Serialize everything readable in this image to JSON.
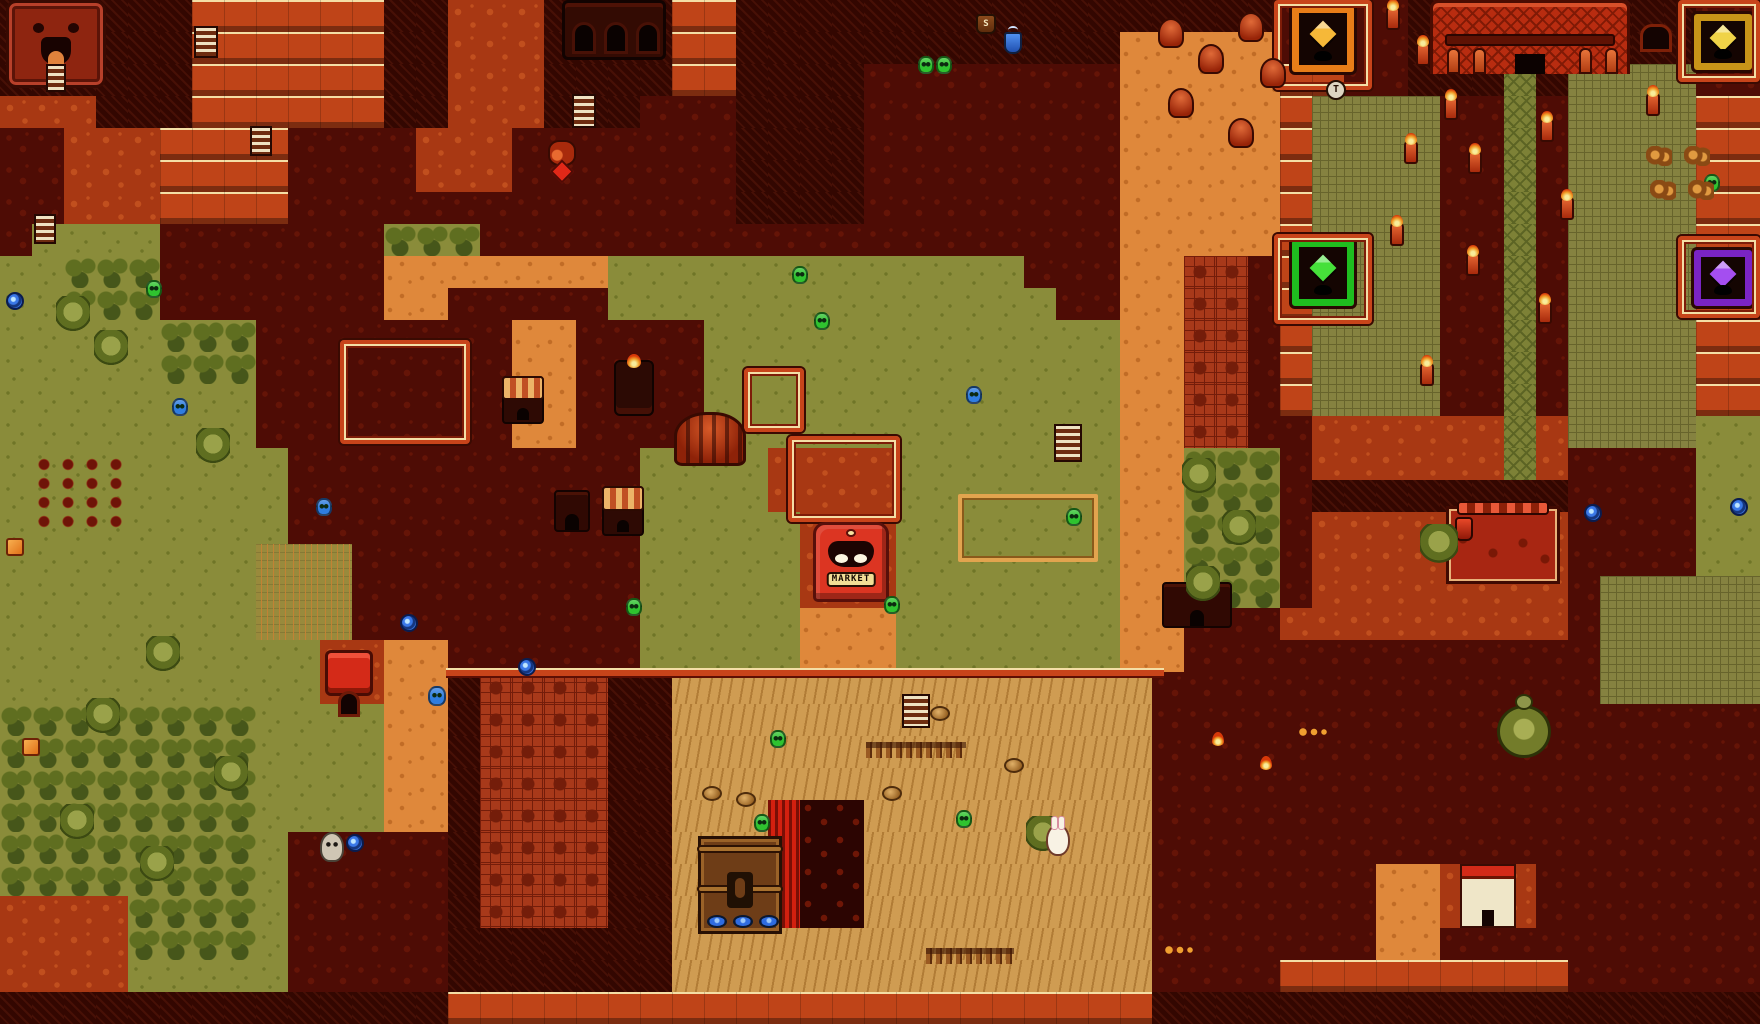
{
  "game": {
    "description": "8-bit volcanic overworld map (Subrosia-style), top-down tile view",
    "visible_text": [
      "MARKET",
      "T",
      "S"
    ]
  },
  "palette": {
    "d": "#4e0c05",
    "d2": "#651407",
    "D": "#330701",
    "D2": "#471006",
    "r": "#a83813",
    "r2": "#c14f1e",
    "R": "#bf4418",
    "R2": "#f4dfa6",
    "o": "#df883b",
    "o2": "#c16c26",
    "g": "#8a8c3a",
    "g2": "#6f7527",
    "t1": "#5f6e20",
    "t2": "#46561a",
    "w": "#998a3c",
    "w2": "#c28234",
    "s": "#cf9c52",
    "s2": "#b17c36",
    "c": "#858240",
    "c2": "#67642c",
    "q": "#a8391a",
    "q2": "#741d0a",
    "k": "#2c0502",
    "k2": "#6e1606",
    "p": "#7d8136",
    "p2": "#5c6424",
    "L": "#d3200f",
    "L2": "#7a0f06",
    "npc_green": "#2fc32f",
    "npc_blue": "#2f7de0",
    "wall_stripe": "#f4dfa6",
    "wall_red": "#c8441a"
  },
  "market": {
    "sign": "MARKET"
  },
  "tiles": {
    "cols": 55,
    "rows": 32,
    "size": 32,
    "legend": {
      "d": "dark-ground",
      "D": "rock-wall",
      "r": "red-ground",
      "R": "red-wall",
      "o": "orange-path",
      "g": "grass",
      "t": "trees",
      "w": "tall-grass",
      "s": "sand",
      "c": "courtyard-tiles",
      "q": "red-floor",
      "k": "dark-wall",
      "p": "temple-path",
      "L": "lava-wall"
    },
    "rows_data": [
      "DDDDDDRRRRRRDDrrrDDDDRRDDDDDDDDDDDDDDDDDddddDDDDDDDDDdd",
      "DDDDDDRRRRRRDDrrrDDDDRRDDDDDDDDDDDDoooooddddDDDDDDDDDdd",
      "DDDDDDRRRRRRDDrrrDDDDRRDDDDddddddddoooooRRddDDDpDccccdd",
      "rrrDDDRRRRRRDDrrrDDDdddDDDDddddddddoooooRccccddpdccccRR",
      "ddrrrRRRRddddrrrdddddddDDDDddddddddoooooRccccddpdccccRR",
      "ddrrrRRRRddddrrrdddddddDDDDddddddddoooooRccccddpdccccRR",
      "ddrrrRRRRddddddddddddddDDDDddddddddoooooRccccddpdccccRR",
      "dggggdddddddtttddddddddddddddddddddoooooRccccddpdccccRR",
      "ggtttdddddddooooooogggggggggggggdddooqqdRccccddpdccccRR",
      "ggtttdddddddoodddddggggggggggggggddooqqdRccccddpdccccRR",
      "gggggtttddddddddooddddgggggggggggggooqqdRccccddpdccccRR",
      "gggggtttddddddddooddddgggggggggggggooqqdRccccddpdccccRR",
      "ggggggggddddddddooddddgggggggggggggooqqdRccccddpdccccRR",
      "ggggggggddddddddooddddgggggggggggggooqqddrrrrrrprccccgg",
      "gggggggggdddddddddddggggrrrrgggggggoottt drrrrrrprddddgg",
      "gggggggggdddddddddddggggrrrrgggggggoottt dDDDDDDDDddddgg",
      "gggggggggdddddddddddgggggrrrgggggggoottt drrrrrrrrddddgg",
      "ggggggggwwwdddddddddgggggrrrgggggggoottt drrrrrrrrddddgg",
      "ggggggggwwwdddddddddgggggrrrgggggggoottt drrrrrrrrdccccc",
      "ggggggggwwwdddddddddgggggooogggggggoodddrrrrrrrrrdccccc",
      "ggggggggggrrooddddddgggggooogggggggoodddddddddddddccccc",
      "ggggggggggrrooDqqqqDDsssssssssssssssddddddddddddddccccc",
      "ttttttttggggooDqqqqDDsssssssssssssssddddddddddddddddddd",
      "ttttttttggggooDqqqqDDsssssssssssssssddddddddddddddddddd",
      "ttttttttggggooDqqqqDDsssssssssssssssddddddddddddddddddd",
      "ttttttttggggooDqqqqDDsssLkksssssssssddddddddddddddddddd",
      "ttttttttgdddddDqqqqDDsssLkksssssssssddddddddddddddddddd",
      "ttttttttgdddddDqqqqDDsssLkksssssssssdddddddoorrrddddddd",
      "rrrrttttgdddddDqqqqDDsssLkksssssssssdddddddoorrrddddddd",
      "rrrrttttgdddddDDDDDDDsssssssssssssssdddddddooddddddddd d",
      "rrrrgggggdddddDDDDDDDsssssssssssssssddddRRRRRRRRRdddddd",
      "DDDDDDDDDDDDDDRRRRRRRRRRRRRRRRRRRRRRDDDDDDDDDDDDDDDDDDD"
    ]
  },
  "landmarks": [
    {
      "name": "carved-face-cave",
      "type": "face",
      "x": 6,
      "y": 0,
      "w": 100,
      "h": 88,
      "interactable": true
    },
    {
      "name": "ruin-tower",
      "type": "tower",
      "x": 562,
      "y": 0,
      "w": 104,
      "h": 60,
      "interactable": true
    },
    {
      "name": "temple",
      "type": "temple",
      "x": 1430,
      "y": 0,
      "w": 200,
      "h": 74,
      "interactable": true
    },
    {
      "name": "warp-pad-orange",
      "type": "pad",
      "x": 1292,
      "y": 6,
      "w": 62,
      "h": 66,
      "frame": "#e87d18",
      "gem": "#f6b838",
      "interactable": true
    },
    {
      "name": "warp-pad-green",
      "type": "pad",
      "x": 1292,
      "y": 240,
      "w": 62,
      "h": 66,
      "frame": "#1fbd1f",
      "gem": "#46e03a",
      "interactable": true
    },
    {
      "name": "warp-pad-yellow",
      "type": "pad",
      "x": 1694,
      "y": 14,
      "w": 58,
      "h": 56,
      "frame": "#c89418",
      "gem": "#f0d348",
      "interactable": true
    },
    {
      "name": "warp-pad-purple",
      "type": "pad",
      "x": 1694,
      "y": 250,
      "w": 58,
      "h": 56,
      "frame": "#7a24c4",
      "gem": "#a44ef0",
      "interactable": true
    },
    {
      "name": "wall-ring-pad-orange",
      "type": "wall",
      "x": 1274,
      "y": 0,
      "w": 98,
      "h": 90
    },
    {
      "name": "wall-ring-pad-green",
      "type": "wall",
      "x": 1274,
      "y": 234,
      "w": 98,
      "h": 90
    },
    {
      "name": "wall-ring-pad-yellow",
      "type": "wall",
      "x": 1678,
      "y": 0,
      "w": 82,
      "h": 82
    },
    {
      "name": "wall-ring-pad-purple",
      "type": "wall",
      "x": 1678,
      "y": 236,
      "w": 82,
      "h": 82
    },
    {
      "name": "wall-ring-market",
      "type": "wall",
      "x": 788,
      "y": 436,
      "w": 112,
      "h": 86
    },
    {
      "name": "wall-ring-west",
      "type": "wall",
      "x": 340,
      "y": 340,
      "w": 130,
      "h": 104
    },
    {
      "name": "wall-ring-center",
      "type": "wall",
      "x": 744,
      "y": 368,
      "w": 60,
      "h": 64
    },
    {
      "name": "compound-wall-top",
      "type": "wallline",
      "x": 446,
      "y": 668,
      "w": 718,
      "h": 10
    },
    {
      "name": "market-building",
      "type": "market",
      "x": 813,
      "y": 522,
      "w": 76,
      "h": 80,
      "interactable": true
    },
    {
      "name": "red-house",
      "type": "house",
      "x": 325,
      "y": 650,
      "w": 48,
      "h": 64,
      "interactable": true
    },
    {
      "name": "furnace-scaffold",
      "type": "furnace",
      "x": 698,
      "y": 836,
      "w": 84,
      "h": 98,
      "interactable": true
    },
    {
      "name": "pipe-works",
      "type": "machine",
      "x": 1446,
      "y": 506,
      "w": 114,
      "h": 78,
      "interactable": true
    },
    {
      "name": "tortoise-statue",
      "type": "statue",
      "x": 1492,
      "y": 694,
      "w": 64,
      "h": 68
    },
    {
      "name": "small-lodge",
      "type": "lodge",
      "x": 1162,
      "y": 582,
      "w": 70,
      "h": 46,
      "interactable": true
    },
    {
      "name": "shrine-hut",
      "type": "lodge",
      "x": 554,
      "y": 490,
      "w": 36,
      "h": 42,
      "interactable": true
    },
    {
      "name": "lodge-front",
      "type": "lodge2",
      "x": 1460,
      "y": 864,
      "w": 56,
      "h": 64,
      "interactable": true
    },
    {
      "name": "awning-hut-west",
      "type": "hut",
      "x": 502,
      "y": 376,
      "w": 42,
      "h": 48,
      "interactable": true
    },
    {
      "name": "awning-hut-east",
      "type": "hut",
      "x": 602,
      "y": 486,
      "w": 42,
      "h": 50,
      "interactable": true
    },
    {
      "name": "flame-fountain",
      "type": "fountain",
      "x": 614,
      "y": 360,
      "w": 40,
      "h": 56
    },
    {
      "name": "striped-mound",
      "type": "mound",
      "x": 674,
      "y": 412,
      "w": 72,
      "h": 54
    },
    {
      "name": "brick-archway",
      "type": "arch",
      "x": 1640,
      "y": 24,
      "w": 32,
      "h": 28,
      "interactable": true
    },
    {
      "name": "sign-post",
      "type": "sign",
      "x": 1326,
      "y": 80,
      "w": 20,
      "h": 20,
      "label": "T"
    },
    {
      "name": "supply-pot",
      "type": "pot",
      "x": 976,
      "y": 14,
      "w": 20,
      "h": 20,
      "label": "S"
    },
    {
      "name": "steaming-jar",
      "type": "potblue",
      "x": 1004,
      "y": 32,
      "w": 18,
      "h": 22
    },
    {
      "name": "crop-rows",
      "type": "crops",
      "x": 28,
      "y": 452,
      "w": 104,
      "h": 78
    },
    {
      "name": "garden-plot",
      "type": "garden",
      "x": 958,
      "y": 494,
      "w": 140,
      "h": 68
    },
    {
      "name": "fence-north",
      "type": "fence",
      "x": 866,
      "y": 742,
      "w": 100,
      "h": 16
    },
    {
      "name": "fence-south",
      "type": "fence",
      "x": 926,
      "y": 948,
      "w": 88,
      "h": 16
    },
    {
      "name": "stairs-1",
      "type": "stairs",
      "x": 46,
      "y": 64,
      "w": 20,
      "h": 28
    },
    {
      "name": "stairs-2",
      "type": "stairs",
      "x": 194,
      "y": 26,
      "w": 24,
      "h": 32
    },
    {
      "name": "stairs-3",
      "type": "stairs",
      "x": 572,
      "y": 94,
      "w": 24,
      "h": 34
    },
    {
      "name": "stairs-4",
      "type": "stairs",
      "x": 250,
      "y": 126,
      "w": 22,
      "h": 30
    },
    {
      "name": "stairs-5",
      "type": "stairs",
      "x": 902,
      "y": 694,
      "w": 28,
      "h": 34
    },
    {
      "name": "stairs-6",
      "type": "stairs",
      "x": 1054,
      "y": 424,
      "w": 28,
      "h": 38
    },
    {
      "name": "stairs-7",
      "type": "stairs",
      "x": 34,
      "y": 214,
      "w": 22,
      "h": 30
    },
    {
      "name": "torch-1",
      "type": "torch",
      "x": 1386,
      "y": 6,
      "w": 14,
      "h": 24
    },
    {
      "name": "torch-2",
      "type": "torch",
      "x": 1416,
      "y": 42,
      "w": 14,
      "h": 24
    },
    {
      "name": "torch-3",
      "type": "torch",
      "x": 1444,
      "y": 96,
      "w": 14,
      "h": 24
    },
    {
      "name": "torch-4",
      "type": "torch",
      "x": 1404,
      "y": 140,
      "w": 14,
      "h": 24
    },
    {
      "name": "torch-5",
      "type": "torch",
      "x": 1468,
      "y": 150,
      "w": 14,
      "h": 24
    },
    {
      "name": "torch-6",
      "type": "torch",
      "x": 1540,
      "y": 118,
      "w": 14,
      "h": 24
    },
    {
      "name": "torch-7",
      "type": "torch",
      "x": 1646,
      "y": 92,
      "w": 14,
      "h": 24
    },
    {
      "name": "torch-8",
      "type": "torch",
      "x": 1390,
      "y": 222,
      "w": 14,
      "h": 24
    },
    {
      "name": "torch-9",
      "type": "torch",
      "x": 1466,
      "y": 252,
      "w": 14,
      "h": 24
    },
    {
      "name": "torch-10",
      "type": "torch",
      "x": 1538,
      "y": 300,
      "w": 14,
      "h": 24
    },
    {
      "name": "torch-11",
      "type": "torch",
      "x": 1420,
      "y": 362,
      "w": 14,
      "h": 24
    },
    {
      "name": "torch-12",
      "type": "torch",
      "x": 1560,
      "y": 196,
      "w": 14,
      "h": 24
    },
    {
      "name": "flame-small-1",
      "type": "flame",
      "x": 1212,
      "y": 732,
      "w": 12,
      "h": 14
    },
    {
      "name": "flame-small-2",
      "type": "flame",
      "x": 1260,
      "y": 756,
      "w": 12,
      "h": 14
    },
    {
      "name": "warp-swirl-1",
      "type": "swirl",
      "x": 6,
      "y": 292,
      "w": 18,
      "h": 18,
      "interactable": true
    },
    {
      "name": "warp-swirl-2",
      "type": "swirl",
      "x": 346,
      "y": 834,
      "w": 18,
      "h": 18,
      "interactable": true
    },
    {
      "name": "warp-swirl-3",
      "type": "swirl",
      "x": 518,
      "y": 658,
      "w": 18,
      "h": 18,
      "interactable": true
    },
    {
      "name": "warp-swirl-4",
      "type": "swirl",
      "x": 400,
      "y": 614,
      "w": 18,
      "h": 18,
      "interactable": true
    },
    {
      "name": "warp-swirl-5",
      "type": "swirl",
      "x": 1584,
      "y": 504,
      "w": 18,
      "h": 18,
      "interactable": true
    },
    {
      "name": "warp-swirl-6",
      "type": "swirl",
      "x": 1730,
      "y": 498,
      "w": 18,
      "h": 18,
      "interactable": true
    },
    {
      "name": "subrosian-green-1",
      "type": "npc",
      "x": 918,
      "y": 56,
      "w": 16,
      "h": 18,
      "color": "#2fc32f",
      "interactable": true
    },
    {
      "name": "subrosian-green-2",
      "type": "npc",
      "x": 936,
      "y": 56,
      "w": 16,
      "h": 18,
      "color": "#2fc32f",
      "interactable": true
    },
    {
      "name": "subrosian-green-3",
      "type": "npc",
      "x": 1704,
      "y": 174,
      "w": 16,
      "h": 18,
      "color": "#2fc32f",
      "interactable": true
    },
    {
      "name": "subrosian-green-4",
      "type": "npc",
      "x": 792,
      "y": 266,
      "w": 16,
      "h": 18,
      "color": "#2fc32f",
      "interactable": true
    },
    {
      "name": "subrosian-green-5",
      "type": "npc",
      "x": 814,
      "y": 312,
      "w": 16,
      "h": 18,
      "color": "#2fc32f",
      "interactable": true
    },
    {
      "name": "subrosian-green-6",
      "type": "npc",
      "x": 770,
      "y": 730,
      "w": 16,
      "h": 18,
      "color": "#2fc32f",
      "interactable": true
    },
    {
      "name": "subrosian-green-7",
      "type": "npc",
      "x": 754,
      "y": 814,
      "w": 16,
      "h": 18,
      "color": "#2fc32f",
      "interactable": true
    },
    {
      "name": "subrosian-green-8",
      "type": "npc",
      "x": 956,
      "y": 810,
      "w": 16,
      "h": 18,
      "color": "#2fc32f",
      "interactable": true
    },
    {
      "name": "subrosian-green-9",
      "type": "npc",
      "x": 1066,
      "y": 508,
      "w": 16,
      "h": 18,
      "color": "#2fc32f",
      "interactable": true
    },
    {
      "name": "subrosian-green-10",
      "type": "npc",
      "x": 626,
      "y": 598,
      "w": 16,
      "h": 18,
      "color": "#2fc32f",
      "interactable": true
    },
    {
      "name": "subrosian-green-11",
      "type": "npc",
      "x": 884,
      "y": 596,
      "w": 16,
      "h": 18,
      "color": "#2fc32f",
      "interactable": true
    },
    {
      "name": "subrosian-green-12",
      "type": "npc",
      "x": 146,
      "y": 280,
      "w": 16,
      "h": 18,
      "color": "#2fc32f",
      "interactable": true
    },
    {
      "name": "subrosian-blue-1",
      "type": "npc",
      "x": 428,
      "y": 686,
      "w": 18,
      "h": 20,
      "color": "#2f7de0",
      "interactable": true
    },
    {
      "name": "subrosian-blue-2",
      "type": "npc",
      "x": 966,
      "y": 386,
      "w": 16,
      "h": 18,
      "color": "#2f7de0",
      "interactable": true
    },
    {
      "name": "subrosian-blue-3",
      "type": "npc",
      "x": 316,
      "y": 498,
      "w": 16,
      "h": 18,
      "color": "#2f7de0",
      "interactable": true
    },
    {
      "name": "subrosian-blue-4",
      "type": "npc",
      "x": 172,
      "y": 398,
      "w": 16,
      "h": 18,
      "color": "#2f7de0",
      "interactable": true
    },
    {
      "name": "tree-1",
      "type": "tree",
      "x": 56,
      "y": 296,
      "w": 34,
      "h": 38
    },
    {
      "name": "tree-2",
      "type": "tree",
      "x": 94,
      "y": 330,
      "w": 34,
      "h": 38
    },
    {
      "name": "tree-3",
      "type": "tree",
      "x": 196,
      "y": 428,
      "w": 34,
      "h": 38
    },
    {
      "name": "tree-4",
      "type": "tree",
      "x": 146,
      "y": 636,
      "w": 34,
      "h": 38
    },
    {
      "name": "tree-5",
      "type": "tree",
      "x": 86,
      "y": 698,
      "w": 34,
      "h": 38
    },
    {
      "name": "tree-6",
      "type": "tree",
      "x": 214,
      "y": 756,
      "w": 34,
      "h": 38
    },
    {
      "name": "tree-7",
      "type": "tree",
      "x": 60,
      "y": 804,
      "w": 34,
      "h": 38
    },
    {
      "name": "tree-8",
      "type": "tree",
      "x": 140,
      "y": 846,
      "w": 34,
      "h": 38
    },
    {
      "name": "tree-9",
      "type": "tree",
      "x": 1182,
      "y": 458,
      "w": 34,
      "h": 38
    },
    {
      "name": "tree-10",
      "type": "tree",
      "x": 1222,
      "y": 510,
      "w": 34,
      "h": 38
    },
    {
      "name": "tree-11",
      "type": "tree",
      "x": 1186,
      "y": 566,
      "w": 34,
      "h": 38
    },
    {
      "name": "tree-12",
      "type": "tree",
      "x": 1420,
      "y": 524,
      "w": 38,
      "h": 42
    },
    {
      "name": "tree-13",
      "type": "tree",
      "x": 1026,
      "y": 816,
      "w": 34,
      "h": 38
    },
    {
      "name": "boulder-1",
      "type": "boulder",
      "x": 702,
      "y": 786,
      "w": 20,
      "h": 15
    },
    {
      "name": "boulder-2",
      "type": "boulder",
      "x": 736,
      "y": 792,
      "w": 20,
      "h": 15
    },
    {
      "name": "boulder-3",
      "type": "boulder",
      "x": 882,
      "y": 786,
      "w": 20,
      "h": 15
    },
    {
      "name": "boulder-4",
      "type": "boulder",
      "x": 1004,
      "y": 758,
      "w": 20,
      "h": 15
    },
    {
      "name": "boulder-5",
      "type": "boulder",
      "x": 930,
      "y": 706,
      "w": 20,
      "h": 15
    },
    {
      "name": "cone-rock-1",
      "type": "cone",
      "x": 1158,
      "y": 18,
      "w": 26,
      "h": 30
    },
    {
      "name": "cone-rock-2",
      "type": "cone",
      "x": 1198,
      "y": 44,
      "w": 26,
      "h": 30
    },
    {
      "name": "cone-rock-3",
      "type": "cone",
      "x": 1238,
      "y": 12,
      "w": 26,
      "h": 30
    },
    {
      "name": "cone-rock-4",
      "type": "cone",
      "x": 1168,
      "y": 88,
      "w": 26,
      "h": 30
    },
    {
      "name": "cone-rock-5",
      "type": "cone",
      "x": 1228,
      "y": 118,
      "w": 26,
      "h": 30
    },
    {
      "name": "cone-rock-6",
      "type": "cone",
      "x": 1260,
      "y": 58,
      "w": 26,
      "h": 30
    },
    {
      "name": "bush-1",
      "type": "bush",
      "x": 1646,
      "y": 146,
      "w": 26,
      "h": 20
    },
    {
      "name": "bush-2",
      "type": "bush",
      "x": 1684,
      "y": 146,
      "w": 26,
      "h": 20
    },
    {
      "name": "bush-3",
      "type": "bush",
      "x": 1650,
      "y": 180,
      "w": 26,
      "h": 20
    },
    {
      "name": "bush-4",
      "type": "bush",
      "x": 1688,
      "y": 180,
      "w": 26,
      "h": 20
    },
    {
      "name": "item-box-1",
      "type": "item",
      "x": 22,
      "y": 738,
      "w": 18,
      "h": 18,
      "interactable": true
    },
    {
      "name": "item-box-2",
      "type": "item",
      "x": 6,
      "y": 538,
      "w": 18,
      "h": 18,
      "interactable": true
    },
    {
      "name": "ore-pile",
      "type": "ore",
      "x": 548,
      "y": 140,
      "w": 28,
      "h": 40,
      "interactable": true
    },
    {
      "name": "skeleton-sprite",
      "type": "skeleton",
      "x": 320,
      "y": 832,
      "w": 24,
      "h": 30,
      "interactable": true
    },
    {
      "name": "bunny-sprite",
      "type": "bunny",
      "x": 1046,
      "y": 824,
      "w": 24,
      "h": 32,
      "interactable": true
    },
    {
      "name": "item-dots-1",
      "type": "dots",
      "x": 1164,
      "y": 944,
      "w": 34,
      "h": 12
    },
    {
      "name": "item-dots-2",
      "type": "dots",
      "x": 1298,
      "y": 726,
      "w": 34,
      "h": 12
    }
  ]
}
